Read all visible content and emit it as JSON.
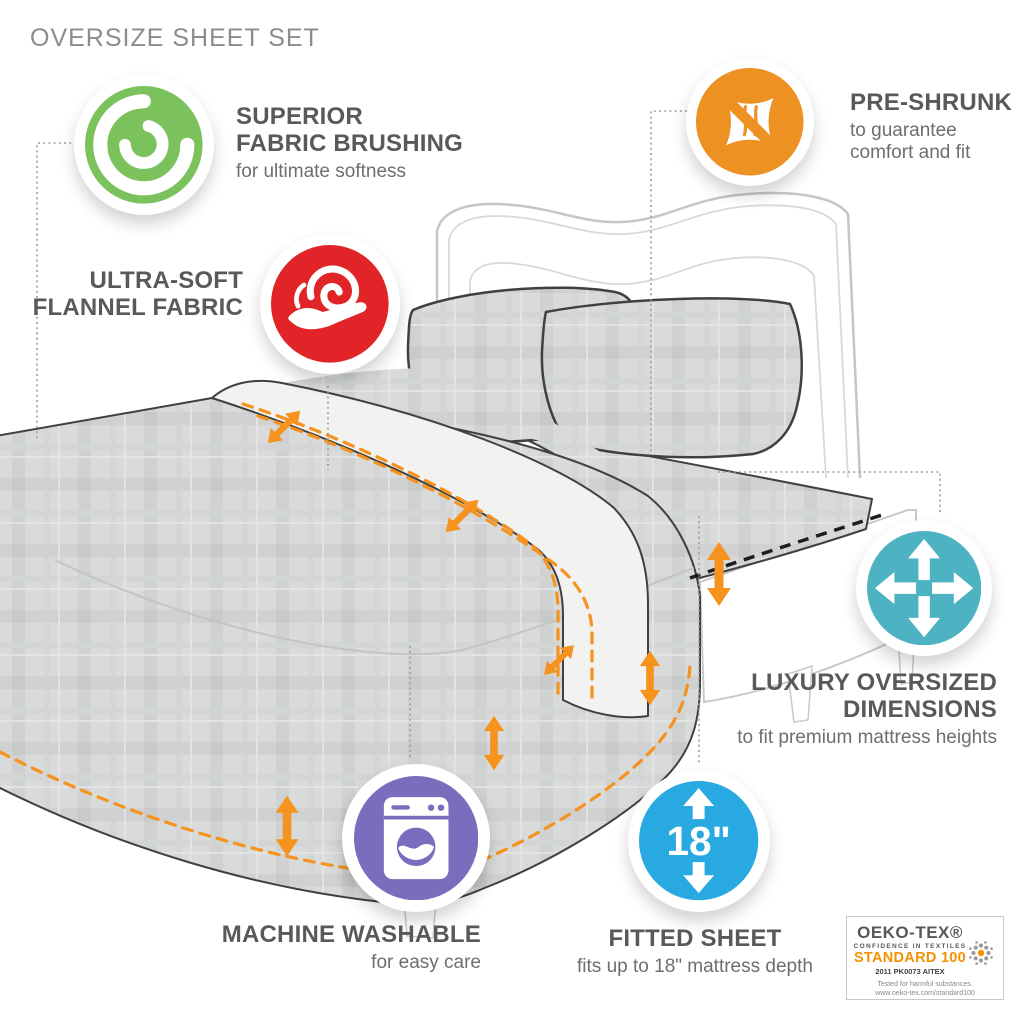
{
  "page": {
    "title": "OVERSIZE SHEET SET"
  },
  "features": {
    "brushing": {
      "title_line1": "SUPERIOR",
      "title_line2": "FABRIC BRUSHING",
      "subtitle": "for ultimate softness",
      "color": "#7cc25c",
      "icon": "brushed-fabric-swirl"
    },
    "flannel": {
      "title_line1": "ULTRA-SOFT",
      "title_line2": "FLANNEL FABRIC",
      "color": "#e02427",
      "icon": "hand-holding-fabric"
    },
    "preshrunk": {
      "title": "PRE-SHRUNK",
      "subtitle_line1": "to guarantee",
      "subtitle_line2": "comfort and fit",
      "color": "#ee9123",
      "icon": "no-shrink-fabric"
    },
    "dimensions": {
      "title_line1": "LUXURY OVERSIZED",
      "title_line2": "DIMENSIONS",
      "subtitle": "to fit premium mattress heights",
      "color": "#4db3c3",
      "icon": "expand-arrows"
    },
    "washable": {
      "title": "MACHINE WASHABLE",
      "subtitle": "for easy care",
      "color": "#7a6dbd",
      "icon": "washing-machine"
    },
    "fitted": {
      "title": "FITTED SHEET",
      "subtitle": "fits up to 18\" mattress depth",
      "badge_label": "18\"",
      "color": "#29a9e1",
      "icon": "depth-arrows"
    }
  },
  "certification": {
    "brand": "OEKO-TEX®",
    "tagline": "CONFIDENCE IN TEXTILES",
    "standard": "STANDARD 100",
    "code": "2011 PK0073 AITEX",
    "note_line1": "Tested for harmful substances.",
    "note_line2": "www.oeko-tex.com/standard100"
  },
  "colors": {
    "arrow_orange": "#f6921e",
    "hem_dash_black": "#1d1d1b",
    "text_dark": "#58595b",
    "text_light": "#6d6e71",
    "title_gray": "#8c8c8c",
    "oeko_orange": "#f39200"
  }
}
